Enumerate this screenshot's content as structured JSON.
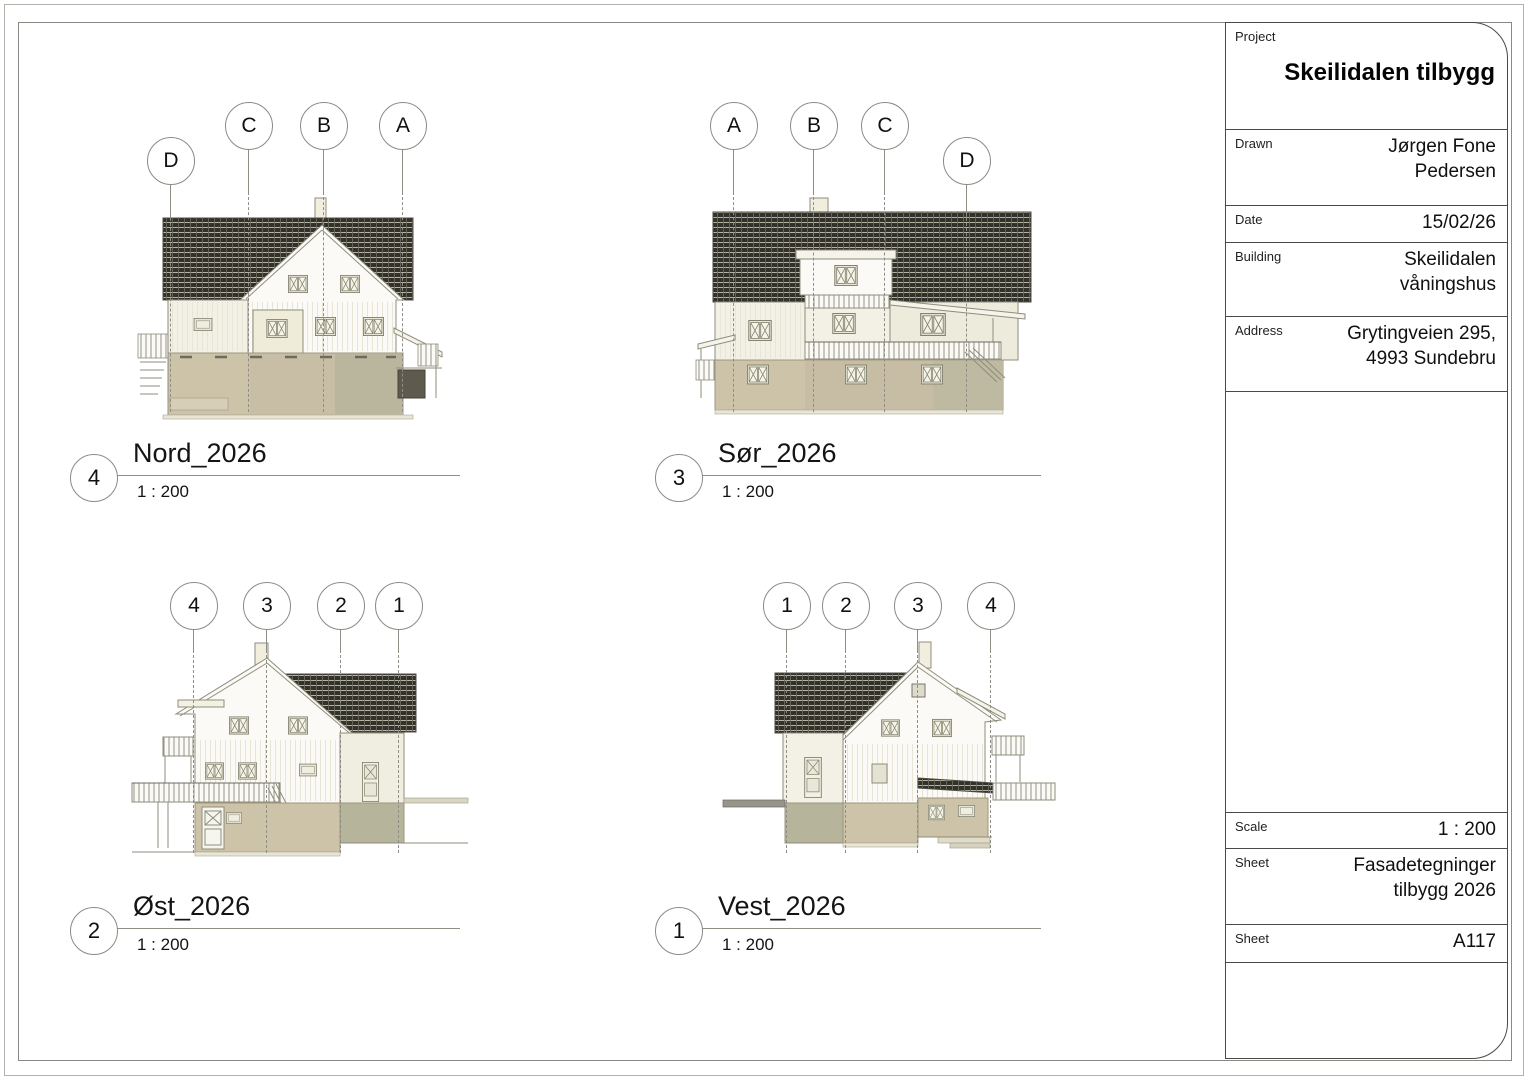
{
  "sheet": {
    "title_block": {
      "project": {
        "label": "Project",
        "value": "Skeilidalen tilbygg"
      },
      "drawn": {
        "label": "Drawn",
        "value": "Jørgen Fone\nPedersen"
      },
      "date": {
        "label": "Date",
        "value": "15/02/26"
      },
      "building": {
        "label": "Building",
        "value": "Skeilidalen\nvåningshus"
      },
      "address": {
        "label": "Address",
        "value": "Grytingveien 295,\n4993 Sundebru"
      },
      "scale": {
        "label": "Scale",
        "value": "1 : 200"
      },
      "sheet_name": {
        "label": "Sheet",
        "value": "Fasadetegninger\ntilbygg 2026"
      },
      "sheet_number": {
        "label": "Sheet",
        "value": "A117"
      }
    },
    "views": [
      {
        "number": "4",
        "name": "Nord_2026",
        "scale": "1 : 200",
        "grid_bubbles": [
          "D",
          "C",
          "B",
          "A"
        ]
      },
      {
        "number": "3",
        "name": "Sør_2026",
        "scale": "1 : 200",
        "grid_bubbles": [
          "A",
          "B",
          "C",
          "D"
        ]
      },
      {
        "number": "2",
        "name": "Øst_2026",
        "scale": "1 : 200",
        "grid_bubbles": [
          "4",
          "3",
          "2",
          "1"
        ]
      },
      {
        "number": "1",
        "name": "Vest_2026",
        "scale": "1 : 200",
        "grid_bubbles": [
          "1",
          "2",
          "3",
          "4"
        ]
      }
    ],
    "colors": {
      "roof_dark": "#32312a",
      "wall_cream": "#f3f1e6",
      "basement_tan": "#cdc3a9",
      "line_gray": "#8e8d7c"
    }
  }
}
